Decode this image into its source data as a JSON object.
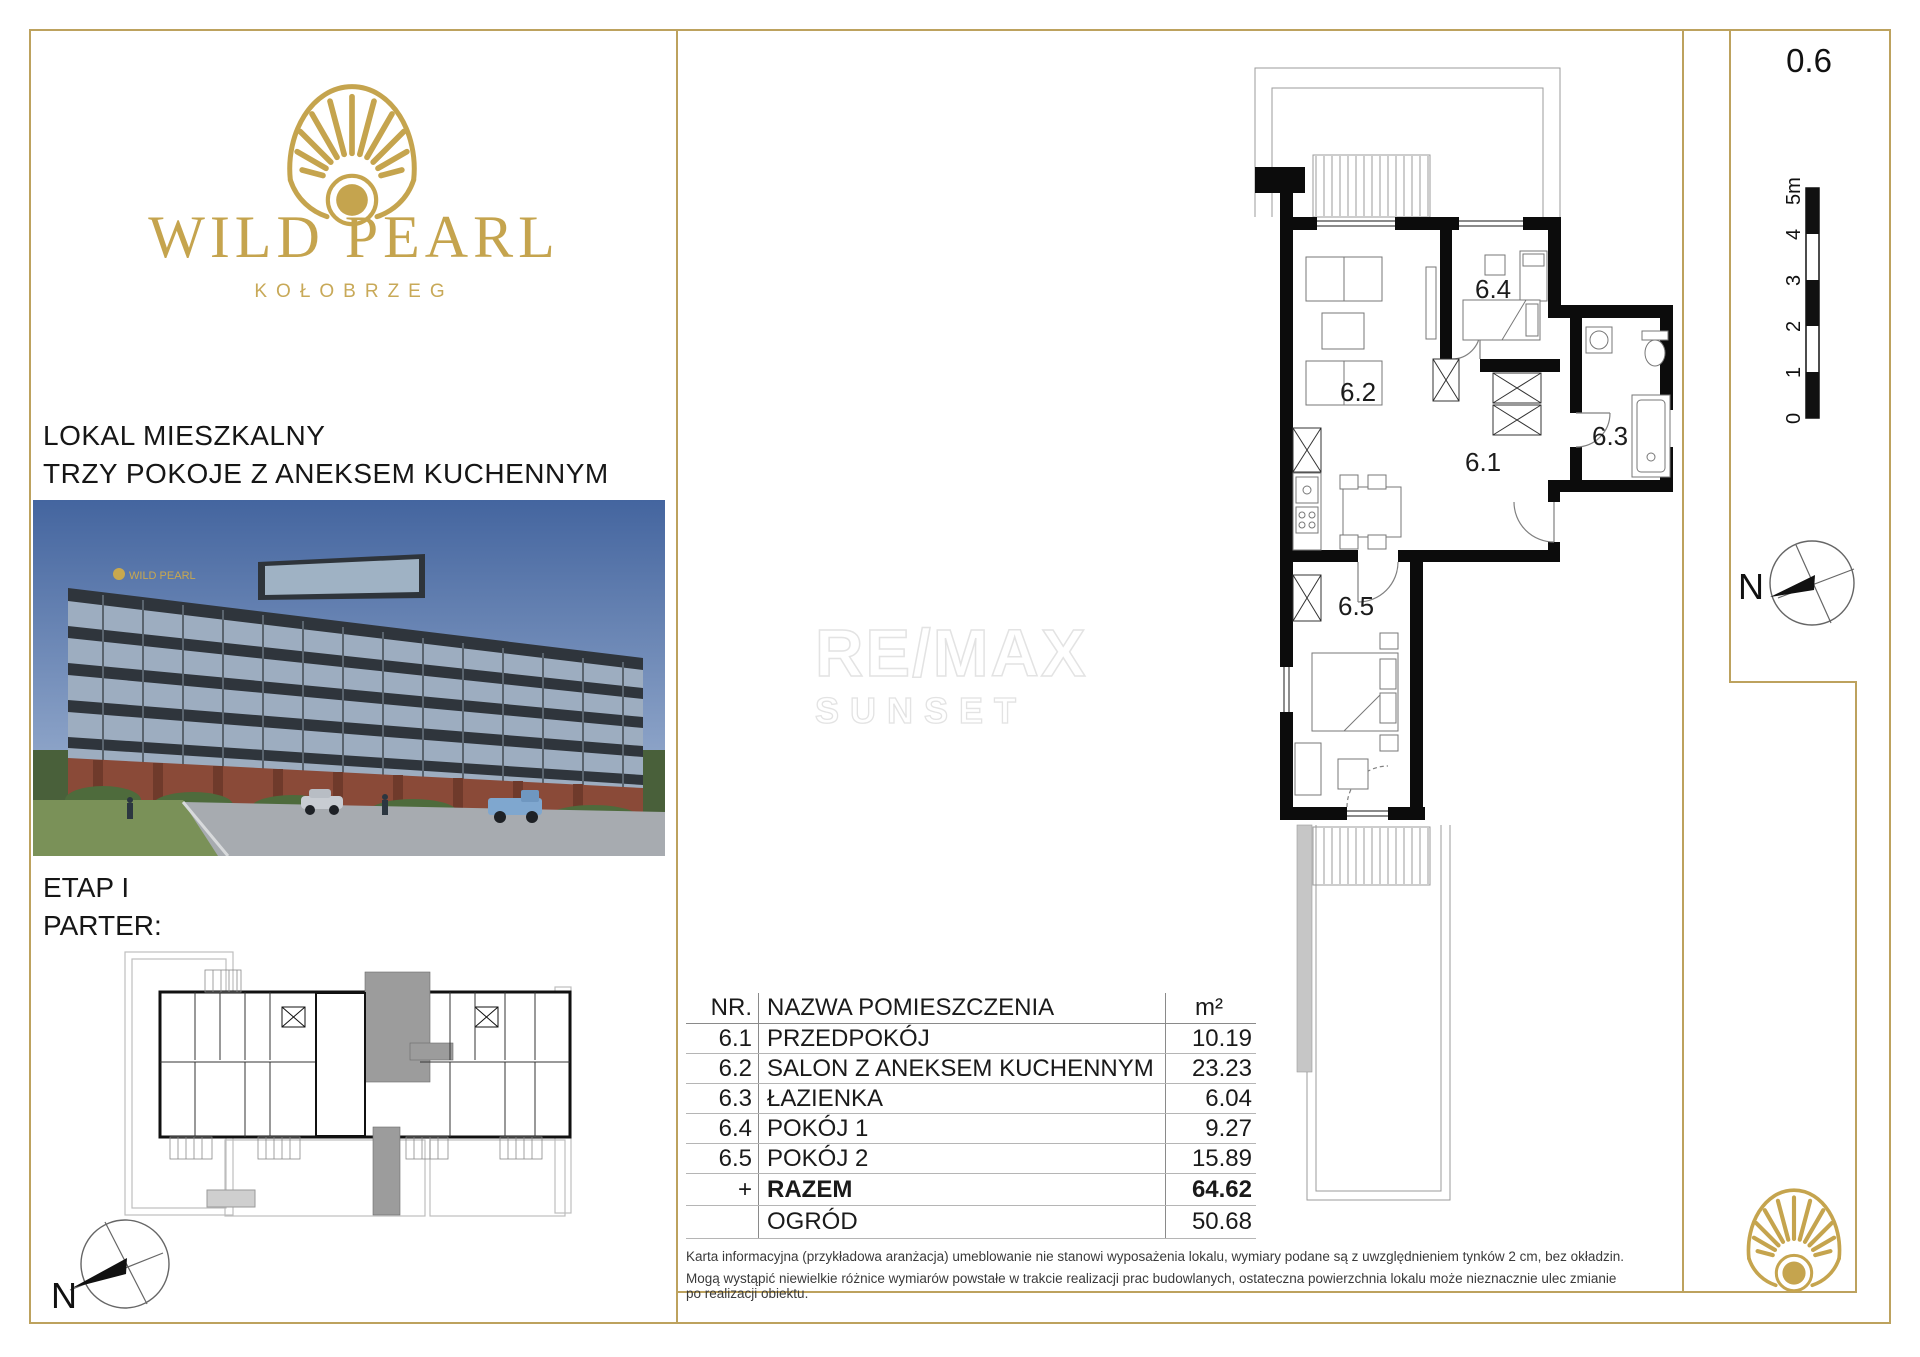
{
  "brand": {
    "name": "WILD PEARL",
    "city": "KOŁOBRZEG"
  },
  "left_panel": {
    "listing_type": "LOKAL MIESZKALNY",
    "listing_subtype": "TRZY POKOJE Z ANEKSEM KUCHENNYM",
    "stage": "ETAP I",
    "floor": "PARTER:",
    "compass": "N"
  },
  "unit": {
    "number": "0.6"
  },
  "floor_plan": {
    "labels": {
      "hall": "6.1",
      "salon": "6.2",
      "bath": "6.3",
      "room1": "6.4",
      "room2": "6.5"
    },
    "scale_labels": [
      "0",
      "1",
      "2",
      "3",
      "4",
      "5m"
    ],
    "compass": "N"
  },
  "watermark": {
    "line1": "RE/MAX",
    "line2": "SUNSET"
  },
  "area_table": {
    "header": {
      "nr": "NR.",
      "name": "NAZWA POMIESZCZENIA",
      "unit": "m²"
    },
    "rows": [
      {
        "nr": "6.1",
        "name": "PRZEDPOKÓJ",
        "area": "10.19"
      },
      {
        "nr": "6.2",
        "name": "SALON Z ANEKSEM KUCHENNYM",
        "area": "23.23"
      },
      {
        "nr": "6.3",
        "name": "ŁAZIENKA",
        "area": "6.04"
      },
      {
        "nr": "6.4",
        "name": "POKÓJ 1",
        "area": "9.27"
      },
      {
        "nr": "6.5",
        "name": "POKÓJ 2",
        "area": "15.89"
      }
    ],
    "total": {
      "nr": "+",
      "name": "RAZEM",
      "area": "64.62"
    },
    "garden": {
      "name": "OGRÓD",
      "area": "50.68"
    }
  },
  "disclaimer": {
    "line1": "Karta informacyjna (przykładowa aranżacja) umeblowanie nie stanowi wyposażenia lokalu, wymiary podane są z uwzględnieniem tynków 2 cm, bez okładzin.",
    "line2": "Mogą wystąpić niewielkie różnice wymiarów powstałe w trakcie realizacji prac budowlanych, ostateczna powierzchnia lokalu może nieznacznie ulec zmianie po realizacji obiektu."
  },
  "colors": {
    "gold": "#bda25e",
    "logo_gold": "#c5a44e",
    "wall": "#0c0c0c"
  }
}
